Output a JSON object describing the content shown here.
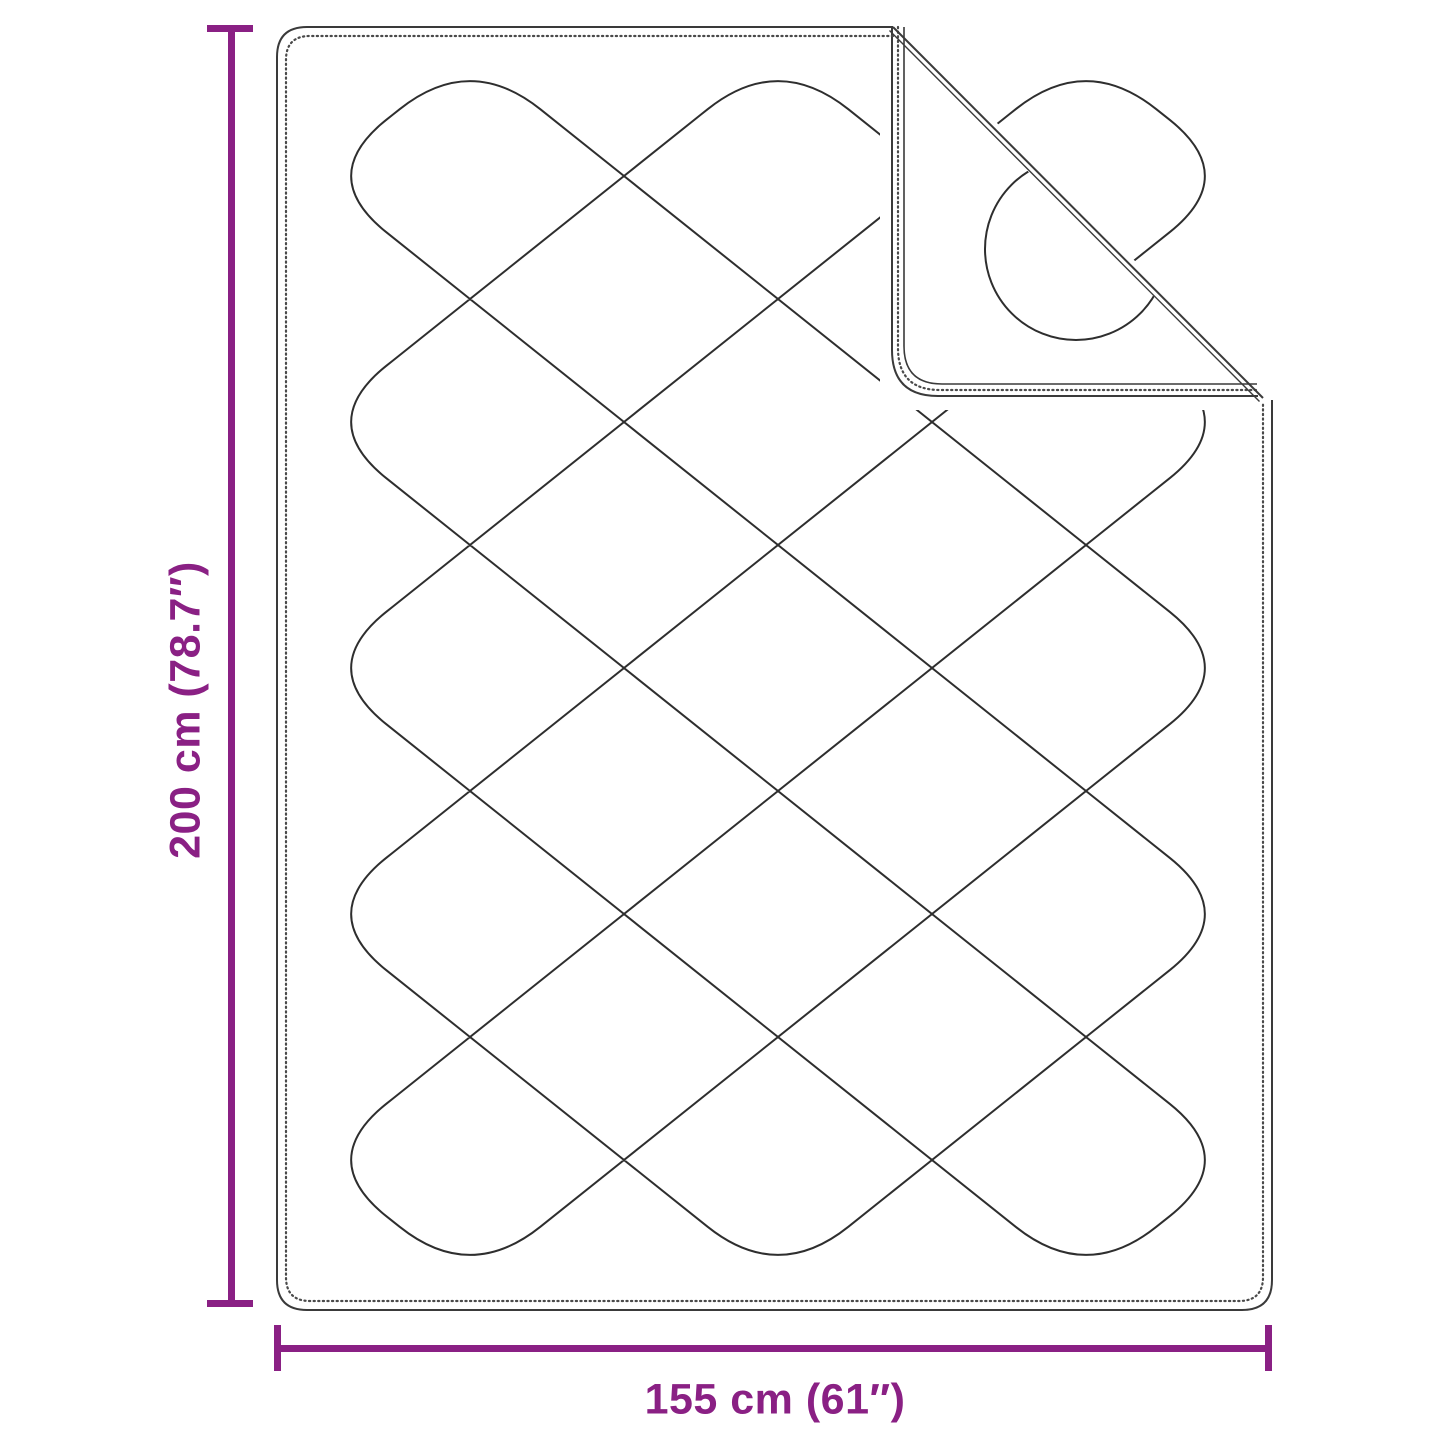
{
  "diagram": {
    "vertical_dimension": {
      "label": "200 cm (78.7″)"
    },
    "horizontal_dimension": {
      "label": "155 cm (61″)"
    },
    "colors": {
      "dimension_accent": "#8A2084",
      "drawing_line": "#333333"
    }
  }
}
